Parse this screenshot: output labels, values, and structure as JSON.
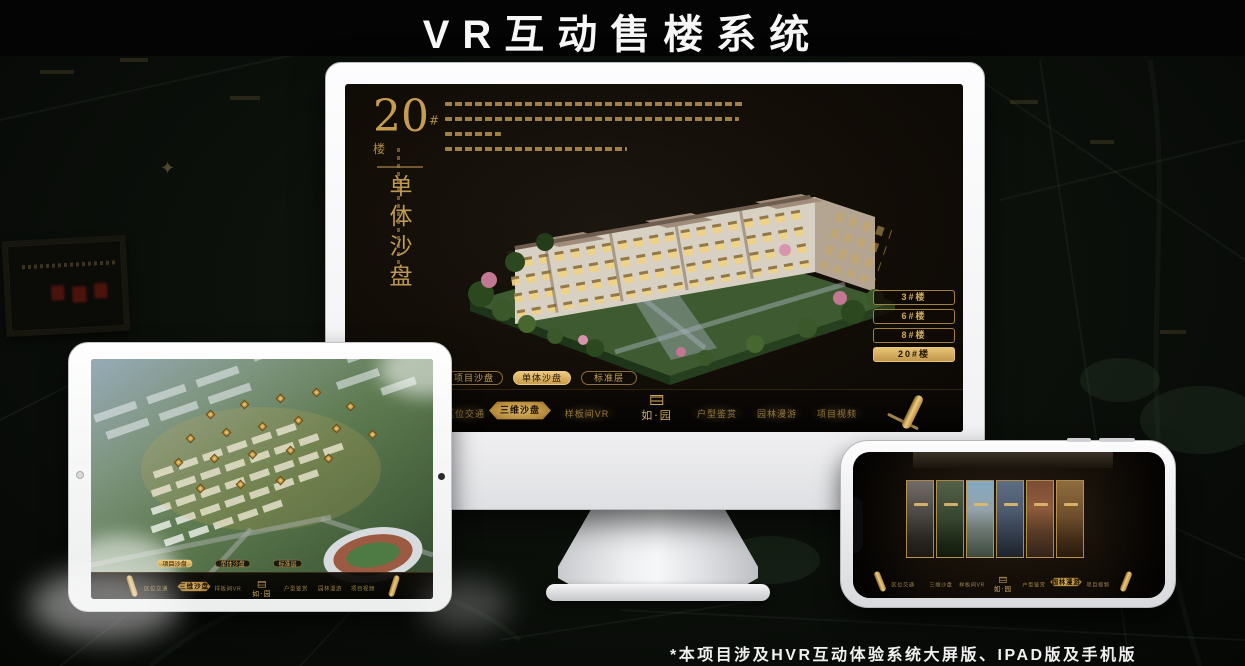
{
  "page": {
    "title": "VR互动售楼系统",
    "footnote": "*本项目涉及HVR互动体验系统大屏版、IPAD版及手机版"
  },
  "colors": {
    "gold": "#c9a45c",
    "gold_selected_bg": "#dcb76b",
    "screen_bg": "#14100a",
    "frame_white": "#f4f4f6",
    "title_text": "#f7f7f7"
  },
  "icons": {
    "scroll": "scroll-icon",
    "camera": "camera-icon",
    "home": "home-button",
    "emblem": "logo-emblem",
    "marker": "building-marker-icon"
  },
  "hero": {
    "number": "20",
    "suffix": "#楼",
    "vertical_title": "单体沙盘"
  },
  "floor_buttons": [
    "3#楼",
    "6#楼",
    "8#楼",
    "20#楼"
  ],
  "floor_selected": "20#楼",
  "tabs": [
    "项目沙盘",
    "单体沙盘",
    "标准层"
  ],
  "monitor_selected_tab": "单体沙盘",
  "tablet_selected_tab": "项目沙盘",
  "nav": {
    "items": [
      "区位交通",
      "三维沙盘",
      "样板间VR",
      "户型鉴赏",
      "园林漫游",
      "项目视频"
    ],
    "logo": "如·园",
    "monitor_active": "三维沙盘",
    "tablet_active": "三维沙盘",
    "phone_active": "园林漫游"
  }
}
